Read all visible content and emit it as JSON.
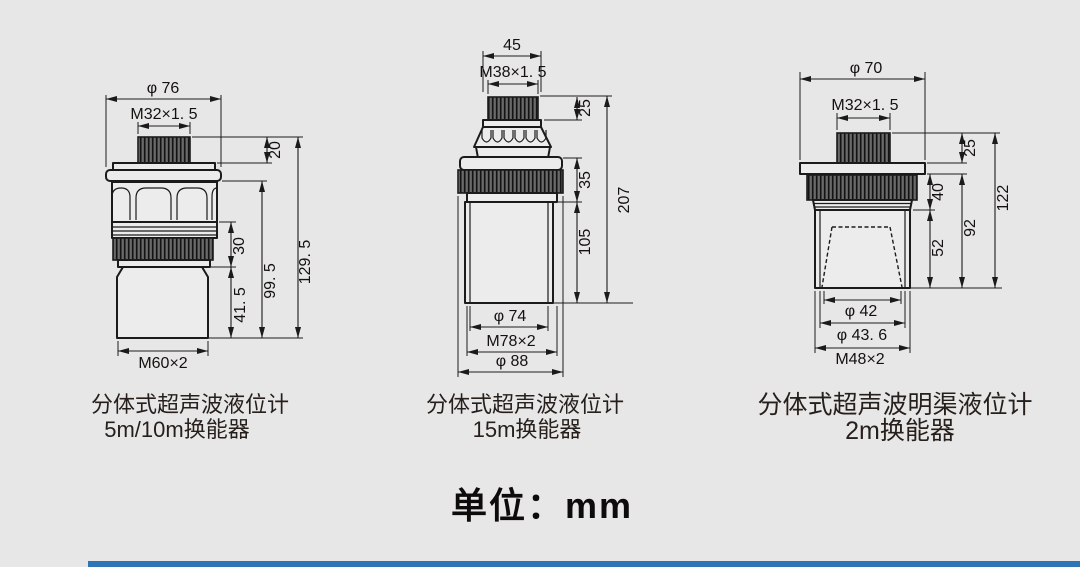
{
  "page": {
    "background_color": "#e8e7e7",
    "accent_bar_color": "#2e75b6",
    "unit_note": "单位：mm"
  },
  "diagrams": [
    {
      "caption_line1": "分体式超声波液位计",
      "caption_line2": "5m/10m换能器",
      "dims": {
        "top_diameter": "φ 76",
        "top_thread": "M32×1. 5",
        "cap_height": "20",
        "neck_height": "30",
        "body_height": "41. 5",
        "lower_height": "99. 5",
        "total_height": "129. 5",
        "bottom_thread": "M60×2"
      }
    },
    {
      "caption_line1": "分体式超声波液位计",
      "caption_line2": "15m换能器",
      "dims": {
        "top_width": "45",
        "top_thread": "M38×1. 5",
        "cap_height": "25",
        "flange_height": "35",
        "body_height": "105",
        "total_height": "207",
        "inner_diameter": "φ 74",
        "bottom_thread": "M78×2",
        "outer_diameter": "φ 88"
      }
    },
    {
      "caption_line1": "分体式超声波明渠液位计",
      "caption_line2": "2m换能器",
      "dims": {
        "top_diameter": "φ 70",
        "top_thread": "M32×1. 5",
        "cap_height": "25",
        "ring_height": "40",
        "body_height": "52",
        "lower_height": "92",
        "total_height": "122",
        "horn_diameter": "φ 42",
        "inner_diameter": "φ 43. 6",
        "bottom_thread": "M48×2"
      }
    }
  ]
}
